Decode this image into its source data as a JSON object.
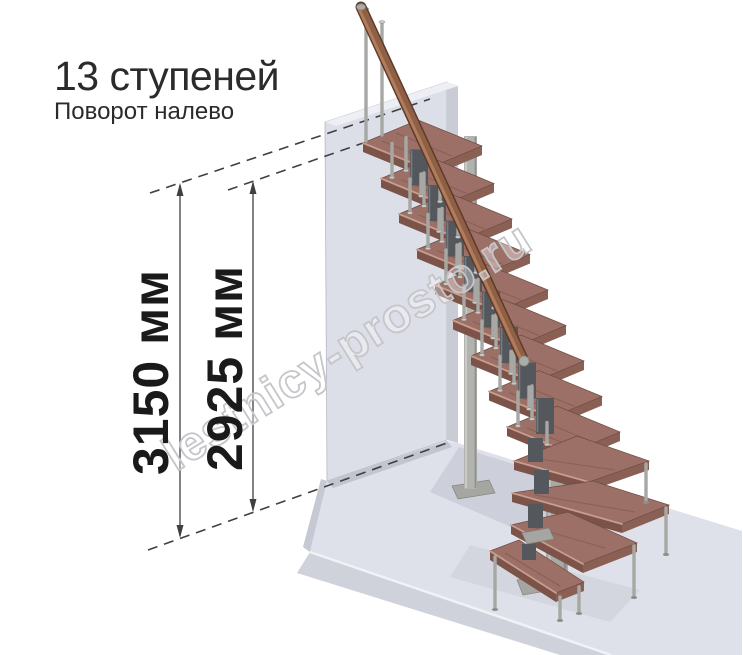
{
  "header": {
    "title": "13 ступеней",
    "subtitle": "Поворот налево"
  },
  "dimensions": {
    "overall_height": "3150 мм",
    "flight_height": "2925 мм"
  },
  "watermark": "lestnicy-prosto.ru",
  "colors": {
    "tread": "#9D7067",
    "tread_front": "#7B5349",
    "handrail": "#8F6046",
    "metal": "#B3B4B0",
    "wall": "#DCDFE8",
    "floor": "#DEE1EA",
    "dimension_lines": "#3E4044",
    "title_text": "#2B2B2B",
    "watermark_outline": "#C6C6CA"
  }
}
